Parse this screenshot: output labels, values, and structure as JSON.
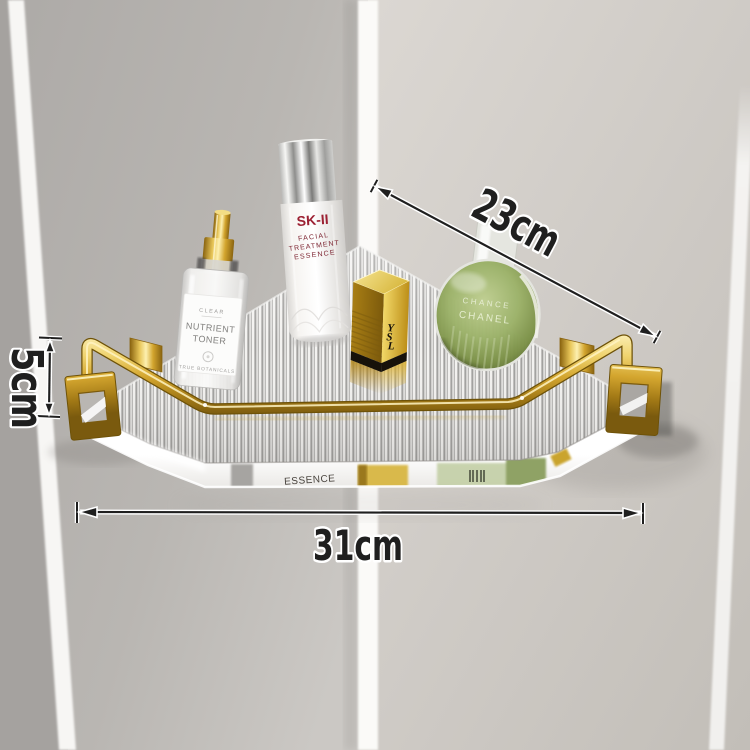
{
  "annotations": {
    "depth_label": "23cm",
    "height_label": "5cm",
    "width_label": "31cm"
  },
  "products": {
    "toner": {
      "tagline": "CLEAR",
      "name_line1": "NUTRIENT",
      "name_line2": "TONER",
      "footer": "TRUE BOTANICALS"
    },
    "essence": {
      "brand": "SK-II",
      "line1": "FACIAL",
      "line2": "TREATMENT",
      "line3": "ESSENCE"
    },
    "lipstick": {
      "monogram_y": "Y",
      "monogram_s": "S",
      "monogram_l": "L"
    },
    "perfume": {
      "line1": "CHANCE",
      "line2": "CHANEL"
    }
  },
  "reflections": {
    "essence_text": "ESSENCE"
  },
  "colors": {
    "gold": "#d0a52e",
    "wall_left": "#b3b0ad",
    "wall_right": "#d4d0cb",
    "corner_stripe": "#fbfaf8",
    "perfume_green": "#8fa562",
    "brand_red": "#9c2133",
    "dimension_ink": "#1f1f1f"
  }
}
